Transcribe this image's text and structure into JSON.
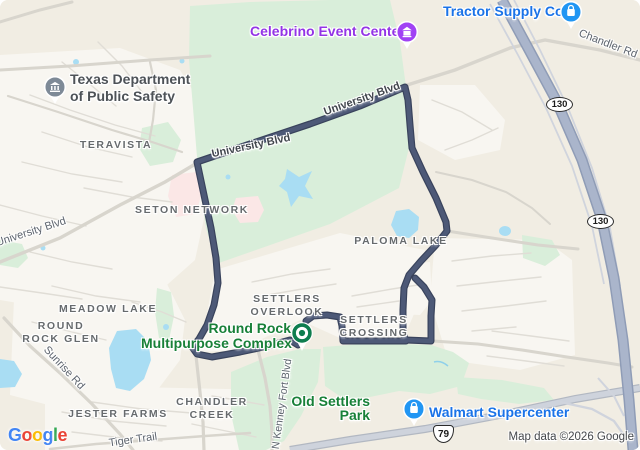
{
  "pois": {
    "tractor_supply": "Tractor Supply Co",
    "celebrino": "Celebrino Event Center",
    "dps_line1": "Texas Department",
    "dps_line2": "of Public Safety",
    "complex_line1": "Round Rock",
    "complex_line2": "Multipurpose Complex",
    "walmart": "Walmart Supercenter",
    "old_settlers_line1": "Old Settlers",
    "old_settlers_line2": "Park"
  },
  "neighborhoods": {
    "teravista": "TERAVISTA",
    "seton": "SETON NETWORK",
    "paloma": "PALOMA LAKE",
    "overlook_line1": "SETTLERS",
    "overlook_line2": "OVERLOOK",
    "crossing_line1": "SETTLERS",
    "crossing_line2": "CROSSING",
    "meadow": "MEADOW LAKE",
    "glen_line1": "ROUND",
    "glen_line2": "ROCK GLEN",
    "jester": "JESTER FARMS",
    "chandler_line1": "CHANDLER",
    "chandler_line2": "CREEK"
  },
  "road_labels": {
    "chandler_rd": "Chandler Rd",
    "university_upper": "University Blvd",
    "university_mid": "University Blvd",
    "university_left": "University Blvd",
    "sunrise": "Sunrise Rd",
    "tiger": "Tiger Trail",
    "kenney": "N Kenney Fort Blvd"
  },
  "shields": {
    "sh130_top": "130",
    "sh130_bottom": "130",
    "us79": "79"
  },
  "attribution": {
    "map_data": "Map data ©2026 Google",
    "logo": [
      {
        "ch": "G",
        "color": "#4285F4"
      },
      {
        "ch": "o",
        "color": "#EA4335"
      },
      {
        "ch": "o",
        "color": "#FBBC05"
      },
      {
        "ch": "g",
        "color": "#4285F4"
      },
      {
        "ch": "l",
        "color": "#34A853"
      },
      {
        "ch": "e",
        "color": "#EA4335"
      }
    ]
  },
  "colors": {
    "route": "#4d5977",
    "park_green": "#d9eeda",
    "water_blue": "#a9ddf3",
    "poi_blue": "#1a73e8",
    "poi_purple": "#9334e6",
    "poi_green": "#188038",
    "toll_road": "#aab5cb"
  }
}
